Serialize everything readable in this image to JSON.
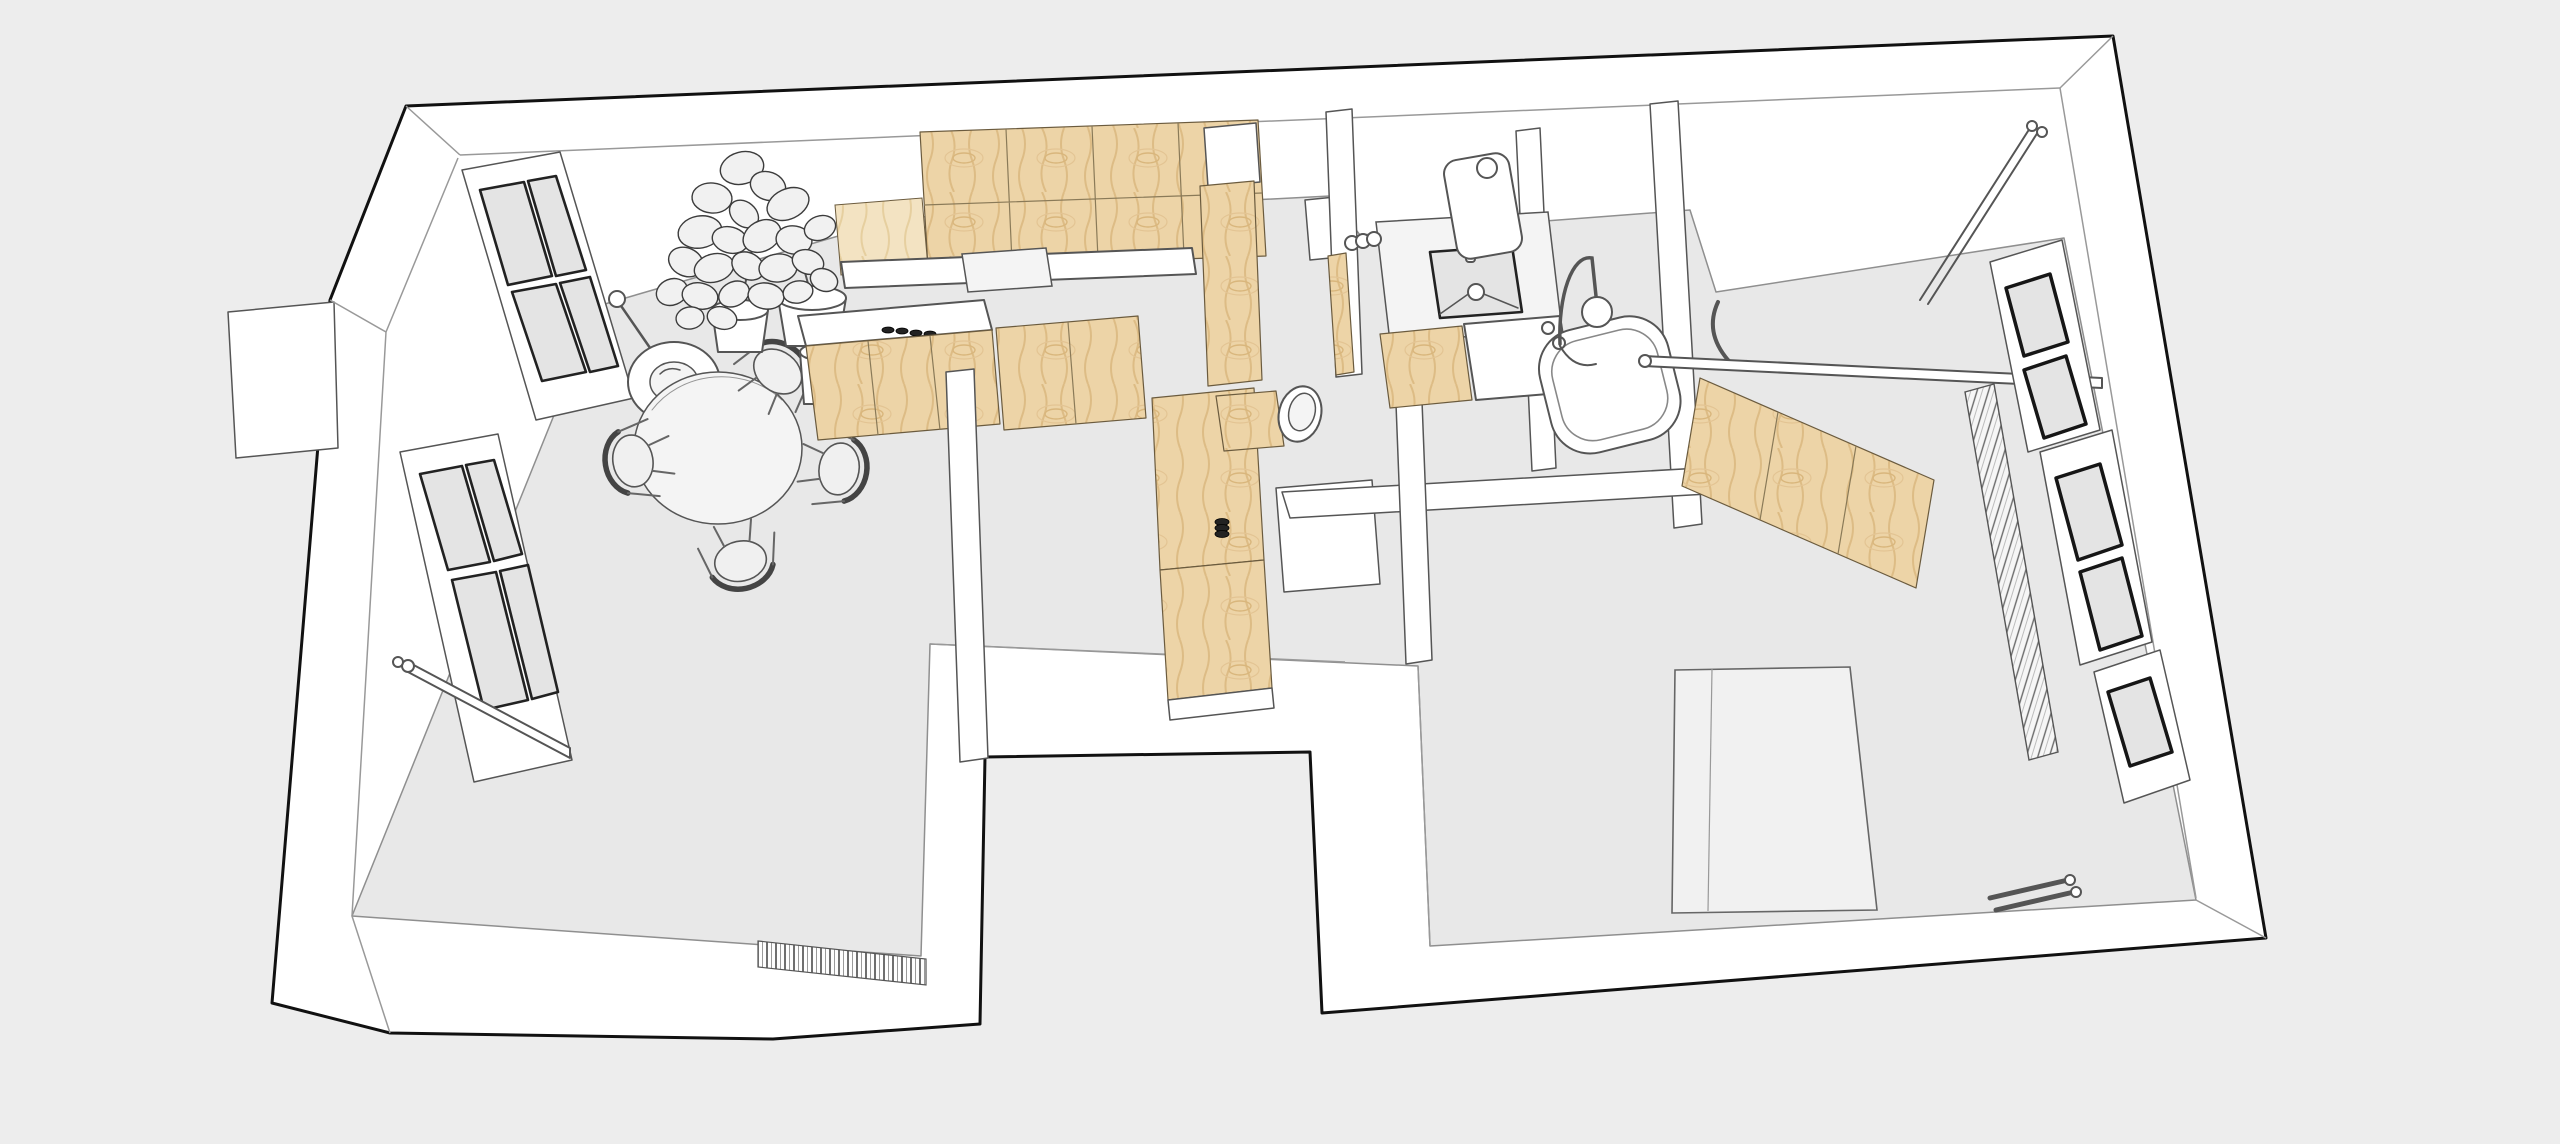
{
  "scene": {
    "kind": "3d-floor-plan-cutaway-render",
    "render_style": "monochrome-line-render-with-plywood-accents",
    "text_content": "none"
  },
  "colors": {
    "background": "#ededed",
    "floor": "#e8e8e8",
    "wall_fill": "#ffffff",
    "outline": "#111111",
    "line": "#555555",
    "thin_line": "#999999",
    "wood": "#edd4a7",
    "wood_grain": "#ddbc85",
    "wood_light": "#f3e3c2",
    "glass": "#e4e4e4",
    "dark_frame": "#161616"
  },
  "rooms": [
    {
      "name": "living-dining-room"
    },
    {
      "name": "kitchen"
    },
    {
      "name": "bathroom"
    },
    {
      "name": "hallway"
    },
    {
      "name": "bedroom"
    },
    {
      "name": "courtyard-notch"
    }
  ],
  "furniture_fixtures": [
    "dining-table",
    "dining-chair",
    "pendant-lamp",
    "potted-plant",
    "plant-pot",
    "window-left-upper",
    "window-left-lower",
    "window-rail-shelf",
    "striped-mat",
    "kitchen-upper-cabinets",
    "kitchen-counter",
    "kitchen-sink",
    "kitchen-hob",
    "kitchen-tall-cabinet",
    "pantry-column",
    "hall-cabinet",
    "door-stop",
    "bathroom-vanity",
    "bathroom-sink",
    "bathroom-mirror",
    "wall-sconce",
    "toiletry-jars",
    "toilet",
    "toilet-cistern-box",
    "bathtub",
    "shower-mixer",
    "wardrobe",
    "lounge-chair",
    "clothes-rail",
    "corner-rod",
    "bed",
    "bedroom-radiator",
    "bedroom-window",
    "heating-pipes",
    "wall-box"
  ]
}
